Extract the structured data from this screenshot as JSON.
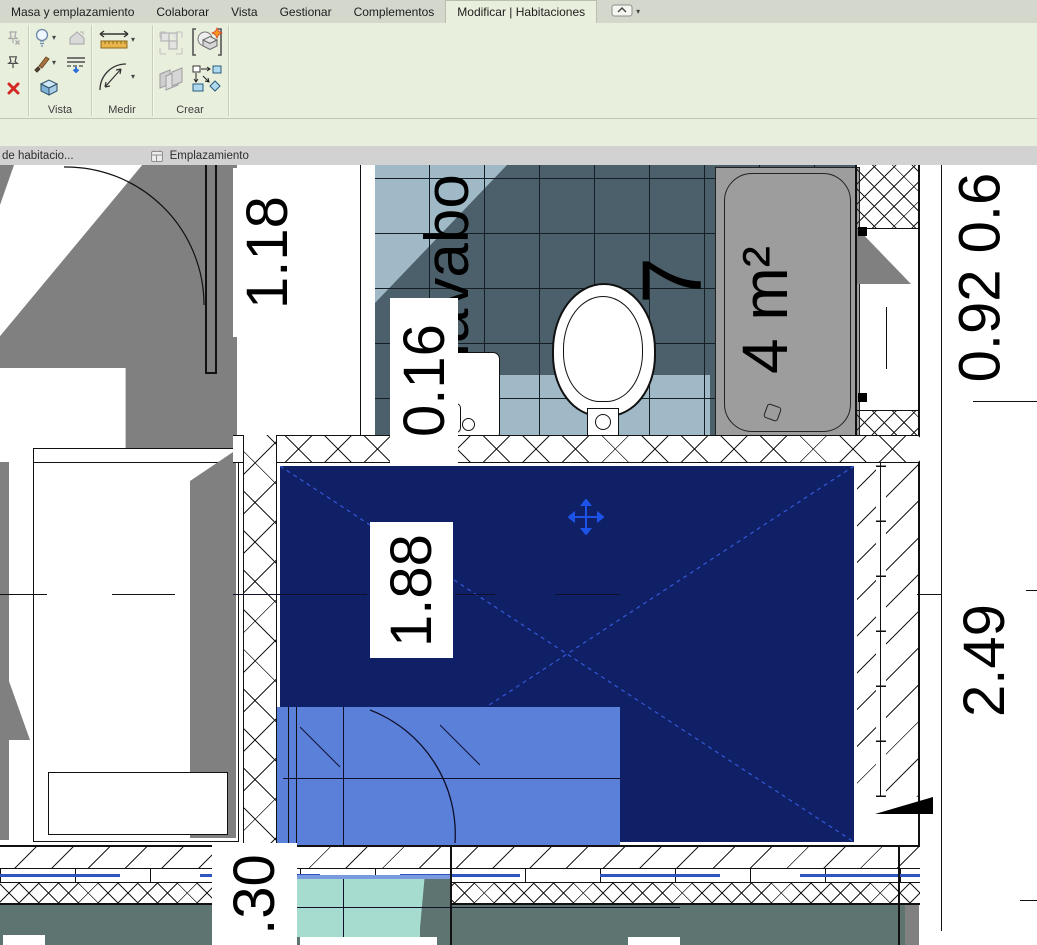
{
  "ribbon": {
    "tabs": [
      {
        "label": "Masa y emplazamiento"
      },
      {
        "label": "Colaborar"
      },
      {
        "label": "Vista"
      },
      {
        "label": "Gestionar"
      },
      {
        "label": "Complementos"
      },
      {
        "label": "Modificar | Habitaciones"
      }
    ],
    "panels": {
      "vista": "Vista",
      "medir": "Medir",
      "crear": "Crear"
    }
  },
  "view_tabs": [
    {
      "label": "de habitacio..."
    },
    {
      "label": "Emplazamiento"
    }
  ],
  "plan": {
    "room_number": "7",
    "room_area": "4 m²",
    "fixture_label": "lavabo",
    "dimensions": {
      "d1": "1.18",
      "d2": "0.16",
      "d3": "1.88",
      "d4": ".30",
      "d5": "2.49",
      "d6": "0.92 0.6"
    }
  },
  "colors": {
    "selection_navy": "#0f2066",
    "highlight_blue": "#5b80da",
    "mint": "#a6dcd0",
    "tile_dark": "#4c606b",
    "tile_light": "#9fb9c6",
    "shadow_gray": "#808080",
    "ground_teal": "#5d7470",
    "ribbon_green": "#e9efdd",
    "tab_bar_gray": "#d3d7cc",
    "accent_blue_line": "#2f55c0",
    "crosshair_blue": "#1c52e8",
    "tub_gray": "#9d9d9d"
  }
}
